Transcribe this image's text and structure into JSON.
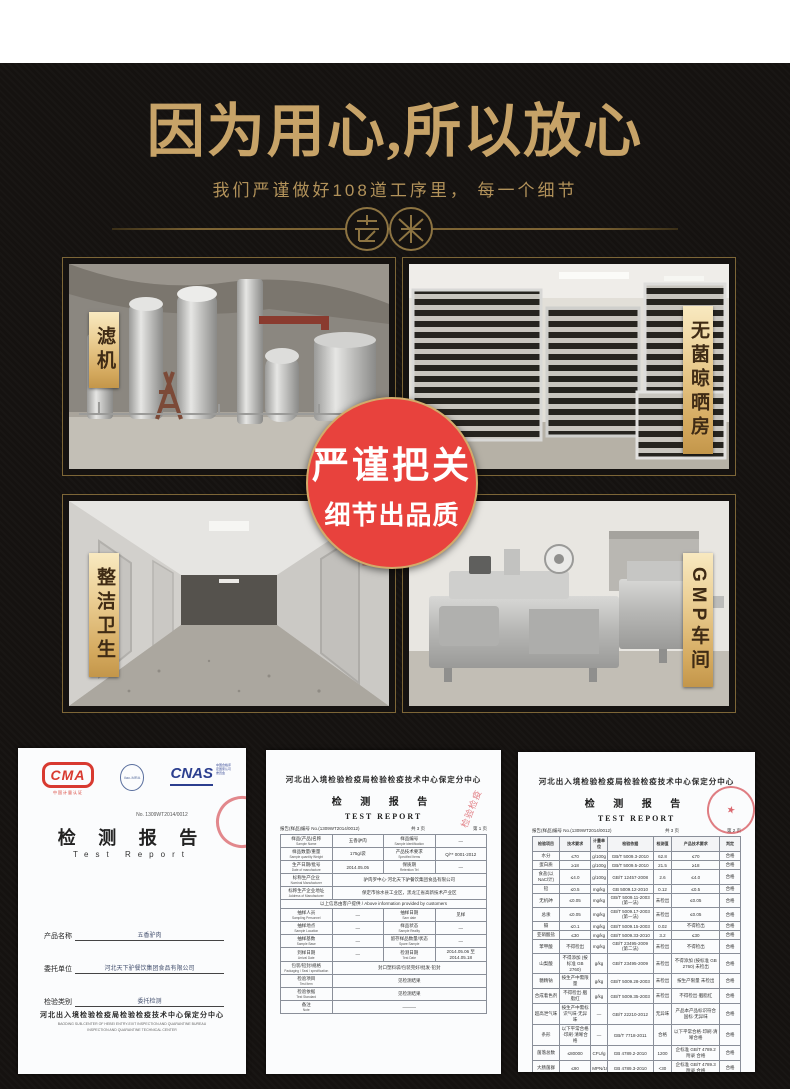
{
  "hero": {
    "title": "因为用心,所以放心",
    "subtitle": "我们严谨做好108道工序里， 每一个细节",
    "title_color": "#c7a368",
    "background_color": "#151210"
  },
  "badge": {
    "line1": "严谨把关",
    "line2": "细节出品质",
    "bg_color": "#e8423d",
    "ring_color": "#d2ab6b"
  },
  "gallery": {
    "items": [
      {
        "label": "滤机",
        "scene": "filter-machines"
      },
      {
        "label": "无菌晾晒房",
        "scene": "drying-racks"
      },
      {
        "label": "整洁卫生",
        "scene": "clean-corridor"
      },
      {
        "label": "GMP车间",
        "scene": "gmp-workshop"
      }
    ],
    "ribbon_color": "#e4c07a"
  },
  "certificates": {
    "cert1": {
      "logos": {
        "cma": "CMA",
        "cma_sub": "中国计量认证",
        "ilac": "ilac-MRA",
        "cnas": "CNAS",
        "cnas_side": "中国合格评定国家认可委员会"
      },
      "report_no": "No. 1309WT2014/0012",
      "title_zh": "检 测 报 告",
      "title_en": "Test Report",
      "fields": [
        {
          "label": "产品名称",
          "value": "五香驴肉"
        },
        {
          "label": "委托单位",
          "value": "河北天下驴餐饮集团食品有限公司"
        },
        {
          "label": "检验类别",
          "value": "委托检测"
        }
      ],
      "footer_zh": "河北出入境检验检疫局检验检疫技术中心保定分中心",
      "footer_en1": "BAODING SUB-CENTER OF HEBEI ENTRY-EXIT INSPECTION AND QUARANTINE BUREAU",
      "footer_en2": "INSPECTION AND QUARANTINE TECHNICAL CENTER"
    },
    "cert2": {
      "header": "河北出入境检验检疫局检验检疫技术中心保定分中心",
      "title_zh": "检 测 报 告",
      "title_en": "TEST REPORT",
      "meta_left": "报告(样品)编号 No.(1309WT2014/0012)",
      "meta_mid": "共 3 页",
      "meta_right": "第 1 页",
      "stamp_text": "检验检疫",
      "rows": [
        {
          "t": "p",
          "c": [
            [
              "样品(产品)名称",
              "Sample Name"
            ],
            "五香驴肉",
            [
              "样品编号",
              "Sample identification"
            ],
            "—"
          ]
        },
        {
          "t": "p",
          "c": [
            [
              "样品数量/重量",
              "Sample quantity Weight"
            ],
            "175g/袋",
            [
              "产品技术要求",
              "Specified Items"
            ],
            "Q/** 0001-2012"
          ]
        },
        {
          "t": "p",
          "c": [
            [
              "生产日期/批号",
              "Date of manufacture"
            ],
            "2014.05.05",
            [
              "保质期",
              "Retention Tel"
            ],
            "—"
          ]
        },
        {
          "t": "w",
          "l": [
            "标称生产企业",
            "Nominal Manufacturer"
          ],
          "v": "驴肉罗中心·河北天下驴餐饮集团食品有限公司"
        },
        {
          "t": "w",
          "l": [
            "标称生产企业地址",
            "Address of Manufacturer"
          ],
          "v": "保定市徐水县工业区，黑龙江省高新技术产业区"
        },
        {
          "t": "f",
          "v": "以上信息由客户提供 / Above information provided by customers"
        },
        {
          "t": "p",
          "c": [
            [
              "抽样人员",
              "Sampling Personnel"
            ],
            "—",
            [
              "抽样日期",
              "Sam date"
            ],
            "见样"
          ]
        },
        {
          "t": "p",
          "c": [
            [
              "抽样地点",
              "Sample Location"
            ],
            "—",
            [
              "样品状态",
              "Sample Reality"
            ],
            "—"
          ]
        },
        {
          "t": "p",
          "c": [
            [
              "抽样基数",
              "Sample Base"
            ],
            "—",
            [
              "留存样品数量/状态",
              "Spare Sample"
            ],
            "—"
          ]
        },
        {
          "t": "p",
          "c": [
            [
              "到样日期",
              "Arrival Date"
            ],
            "—",
            [
              "检测日期",
              "Test Date"
            ],
            "2014.05.06 至 2014.05.18"
          ]
        },
        {
          "t": "w",
          "l": [
            "包装/铅封/规格",
            "Packaging / Seal / specification"
          ],
          "v": "封口塑料袋/包装完好/批发·铅封"
        },
        {
          "t": "w",
          "l": [
            "检验项目",
            "Test Item"
          ],
          "v": "见检测结果"
        },
        {
          "t": "w",
          "l": [
            "检验依据",
            "Test Standard"
          ],
          "v": "见检测结果"
        },
        {
          "t": "w",
          "l": [
            "备注",
            "Note"
          ],
          "v": "———"
        }
      ]
    },
    "cert3": {
      "header": "河北出入境检验检疫局检验检疫技术中心保定分中心",
      "title_zh": "检 测 报 告",
      "title_en": "TEST REPORT",
      "meta_left": "报告(样品)编号 No.(1309WT2014/0012)",
      "meta_mid": "共 3 页",
      "meta_right": "第 2 页",
      "stamp_symbol": "★",
      "col_headers": [
        "检验项目",
        "技术要求",
        "计量单位",
        "检验依据",
        "检测值",
        "产品技术要求",
        "判定"
      ],
      "rows": [
        [
          "水分",
          "≤70",
          "g/100g",
          "GB/T 5009.3-2010",
          "62.8",
          "≤70",
          "合格"
        ],
        [
          "蛋白质",
          "≥18",
          "g/100g",
          "GB/T 5009.5-2010",
          "21.5",
          "≥18",
          "合格"
        ],
        [
          "食盐(以NaCl计)",
          "≤4.0",
          "g/100g",
          "GB/T 12457-2008",
          "2.6",
          "≤4.0",
          "合格"
        ],
        [
          "铅",
          "≤0.5",
          "mg/kg",
          "GB 5009.12-2010",
          "0.12",
          "≤0.5",
          "合格"
        ],
        [
          "无机砷",
          "≤0.05",
          "mg/kg",
          "GB/T 5009.11-2003 (第一法)",
          "未检出",
          "≤0.05",
          "合格"
        ],
        [
          "总汞",
          "≤0.05",
          "mg/kg",
          "GB/T 5009.17-2003 (第一法)",
          "未检出",
          "≤0.05",
          "合格"
        ],
        [
          "镉",
          "≤0.1",
          "mg/kg",
          "GB/T 5009.15-2003",
          "0.02",
          "不得检出",
          "合格"
        ],
        [
          "亚硝酸盐",
          "≤30",
          "mg/kg",
          "GB/T 5009.33-2010",
          "3.2",
          "≤30",
          "合格"
        ],
        [
          "苯甲酸",
          "不得检出",
          "mg/kg",
          "GB/T 23495-2009 (第二法)",
          "未检出",
          "不得检出",
          "合格"
        ],
        [
          "山梨酸",
          "不得添加 (按标准 GB 2760)",
          "g/kg",
          "GB/T 23495-2009",
          "未检出",
          "不得添加 (按标准 GB 2760) 未检出",
          "合格"
        ],
        [
          "糖精钠",
          "按生产中需限量",
          "g/kg",
          "GB/T 5009.28-2003",
          "未检出",
          "按生产限量 未检出",
          "合格"
        ],
        [
          "合成着色剂",
          "不得检出·胭脂红",
          "g/kg",
          "GB/T 5009.35-2003",
          "未检出",
          "不得检出·胭脂红",
          "合格"
        ],
        [
          "超高泄气味",
          "按生产中需标识气味·无异味",
          "—",
          "GB/T 22210-2012",
          "无异味",
          "产品本产品标识符合国标·无异味",
          "合格"
        ],
        [
          "条形",
          "以下平常合格·印刷·清晰合格",
          "—",
          "GB/T 7718-2011",
          "合格",
          "以下平常合格·印刷·清晰合格",
          "合格"
        ],
        [
          "菌落总数",
          "≤80000",
          "CFU/g",
          "GB 4789.2-2010",
          "1200",
          "企标准 GB/T 4789.2 附录 合格",
          "合格"
        ],
        [
          "大肠菌群",
          "≤90",
          "MPN/100g",
          "GB 4789.3-2010",
          "<30",
          "企标准 GB/T 4789.3 附录 合格",
          "合格"
        ],
        [
          "沙门氏菌",
          "/25g 中",
          "—",
          "GB 4789.4-2012",
          "未检出",
          "企标准 GB/T 4789.4 附录 合格",
          "合格"
        ],
        [
          "金黄色葡萄球菌",
          "不得检出不得菌落·检出·计量",
          "—",
          "GB 4789.10-2010",
          "未检出",
          "企标准 GB/T 4789.10 附录 合格",
          "合格"
        ],
        [
          "致泻大肠埃希氏菌",
          "不得检出不得大肠埃希氏菌·检出 合计",
          "—",
          "GB/T 4789.6-2003",
          "未检出",
          "企标准 GB/T 4789.6 附录 合格",
          "合格"
        ]
      ]
    }
  }
}
